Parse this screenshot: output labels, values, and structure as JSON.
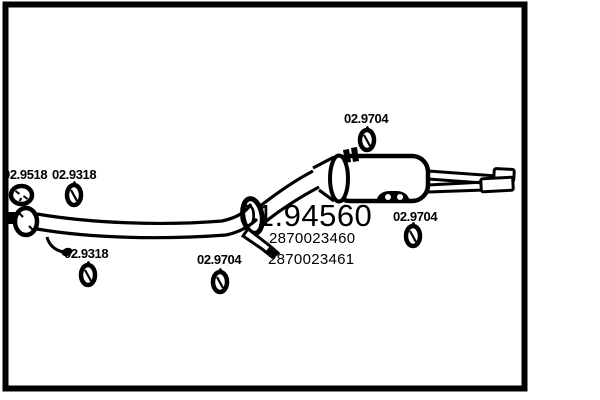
{
  "page": {
    "background": "#ffffff",
    "ink": "#000000"
  },
  "diagram": {
    "kind": "exhaust-system-parts-diagram",
    "main_part_number": "01.94560",
    "oe_numbers": [
      "2870023460",
      "2870023461"
    ],
    "labels": {
      "front_clamp": "02.9518",
      "front_mount_upper": "02.9318",
      "front_mount_lower": "02.9318",
      "center_mount": "02.9704",
      "muffler_top_mount": "02.9704",
      "muffler_rear_mount": "02.9704"
    },
    "icons": {
      "clamp": "clamp-ring-icon",
      "mount": "rubber-mount-icon"
    }
  }
}
